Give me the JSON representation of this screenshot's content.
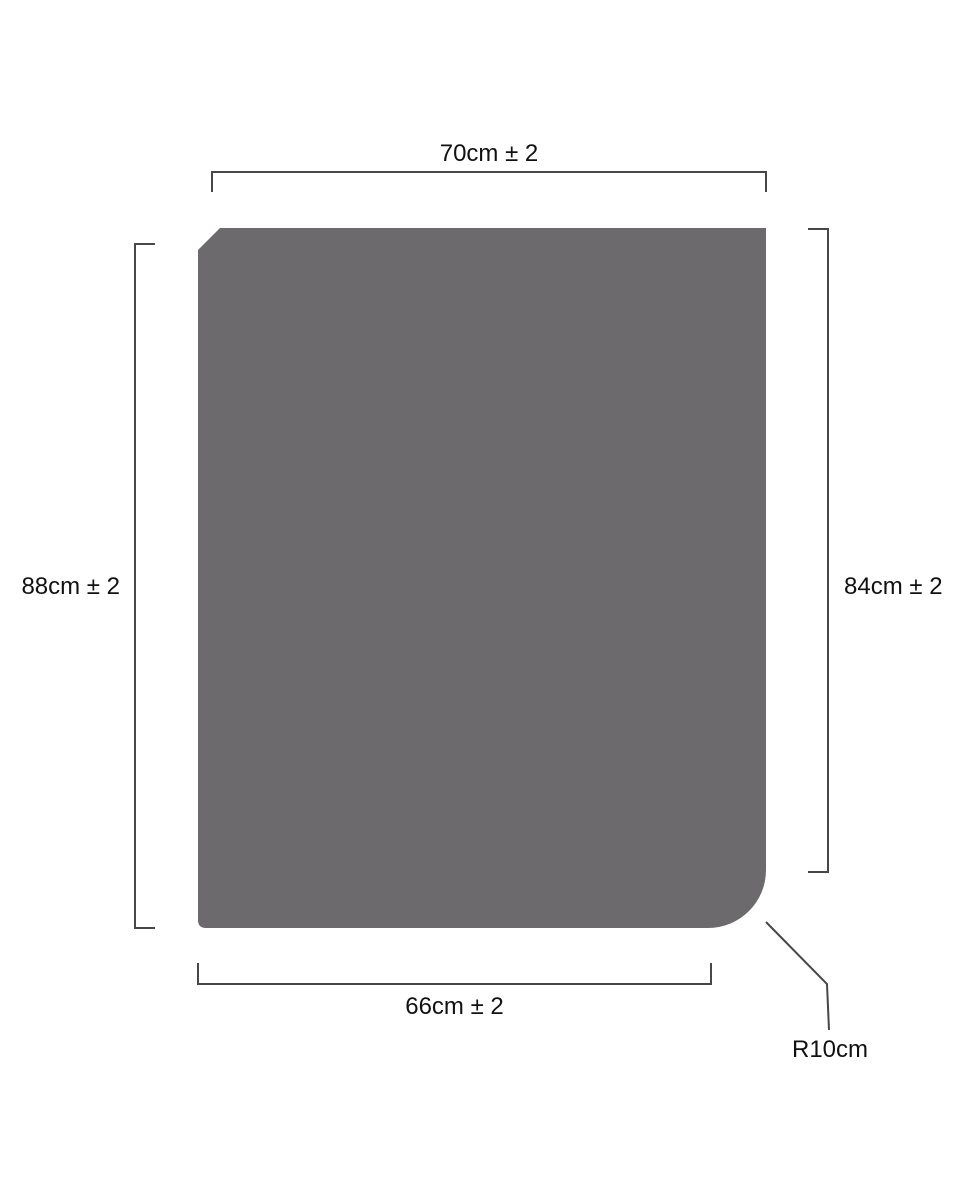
{
  "diagram": {
    "type": "technical-dimension-drawing",
    "background_color": "#ffffff",
    "line_color": "#474747",
    "text_color": "#111111",
    "shape": {
      "name": "panel-with-rounded-corner",
      "fill_color": "#6c6a6c"
    },
    "dimensions": {
      "top_width": "70cm ± 2",
      "left_height": "88cm ± 2",
      "right_height": "84cm ± 2",
      "bottom_width": "66cm ± 2",
      "corner_radius": "R10cm"
    }
  }
}
